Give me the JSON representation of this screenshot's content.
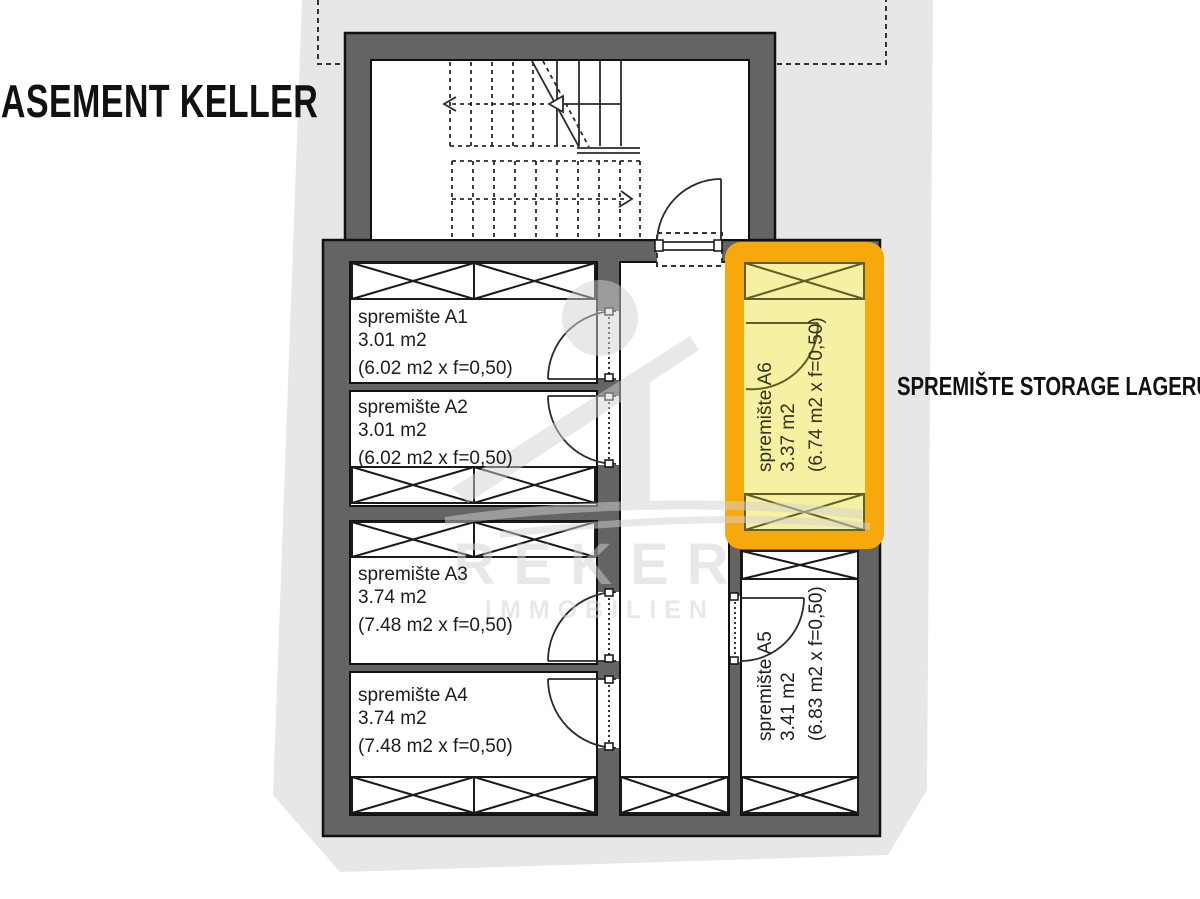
{
  "title": {
    "lines": [
      "PODRUM",
      "BASEMENT",
      "KELLER"
    ]
  },
  "legend": {
    "lines": [
      "SPREMIŠTE",
      "STORAGE",
      "LAGERUNG"
    ]
  },
  "watermark": {
    "brand": "REKER",
    "subtitle": "IMMOBILIEN"
  },
  "rooms": [
    {
      "id": "A1",
      "name": "spremište A1",
      "area": "3.01 m2",
      "formula": "(6.02 m2 x f=0,50)",
      "highlighted": false
    },
    {
      "id": "A2",
      "name": "spremište A2",
      "area": "3.01 m2",
      "formula": "(6.02 m2 x f=0,50)",
      "highlighted": false
    },
    {
      "id": "A3",
      "name": "spremište A3",
      "area": "3.74 m2",
      "formula": "(7.48 m2 x f=0,50)",
      "highlighted": false
    },
    {
      "id": "A4",
      "name": "spremište A4",
      "area": "3.74 m2",
      "formula": "(7.48 m2 x f=0,50)",
      "highlighted": false
    },
    {
      "id": "A5",
      "name": "spremište A5",
      "area": "3.41 m2",
      "formula": "(6.83 m2 x f=0,50)",
      "highlighted": false
    },
    {
      "id": "A6",
      "name": "spremište A6",
      "area": "3.37 m2",
      "formula": "(6.74 m2 x f=0,50)",
      "highlighted": true
    }
  ],
  "colors": {
    "highlight_border": "#F7A80A",
    "highlight_fill": "#F5F0A2",
    "wall_fill": "#646464",
    "site_fill": "#E7E7E7",
    "line": "#1A1A1A",
    "watermark": "#D2D2D2"
  }
}
